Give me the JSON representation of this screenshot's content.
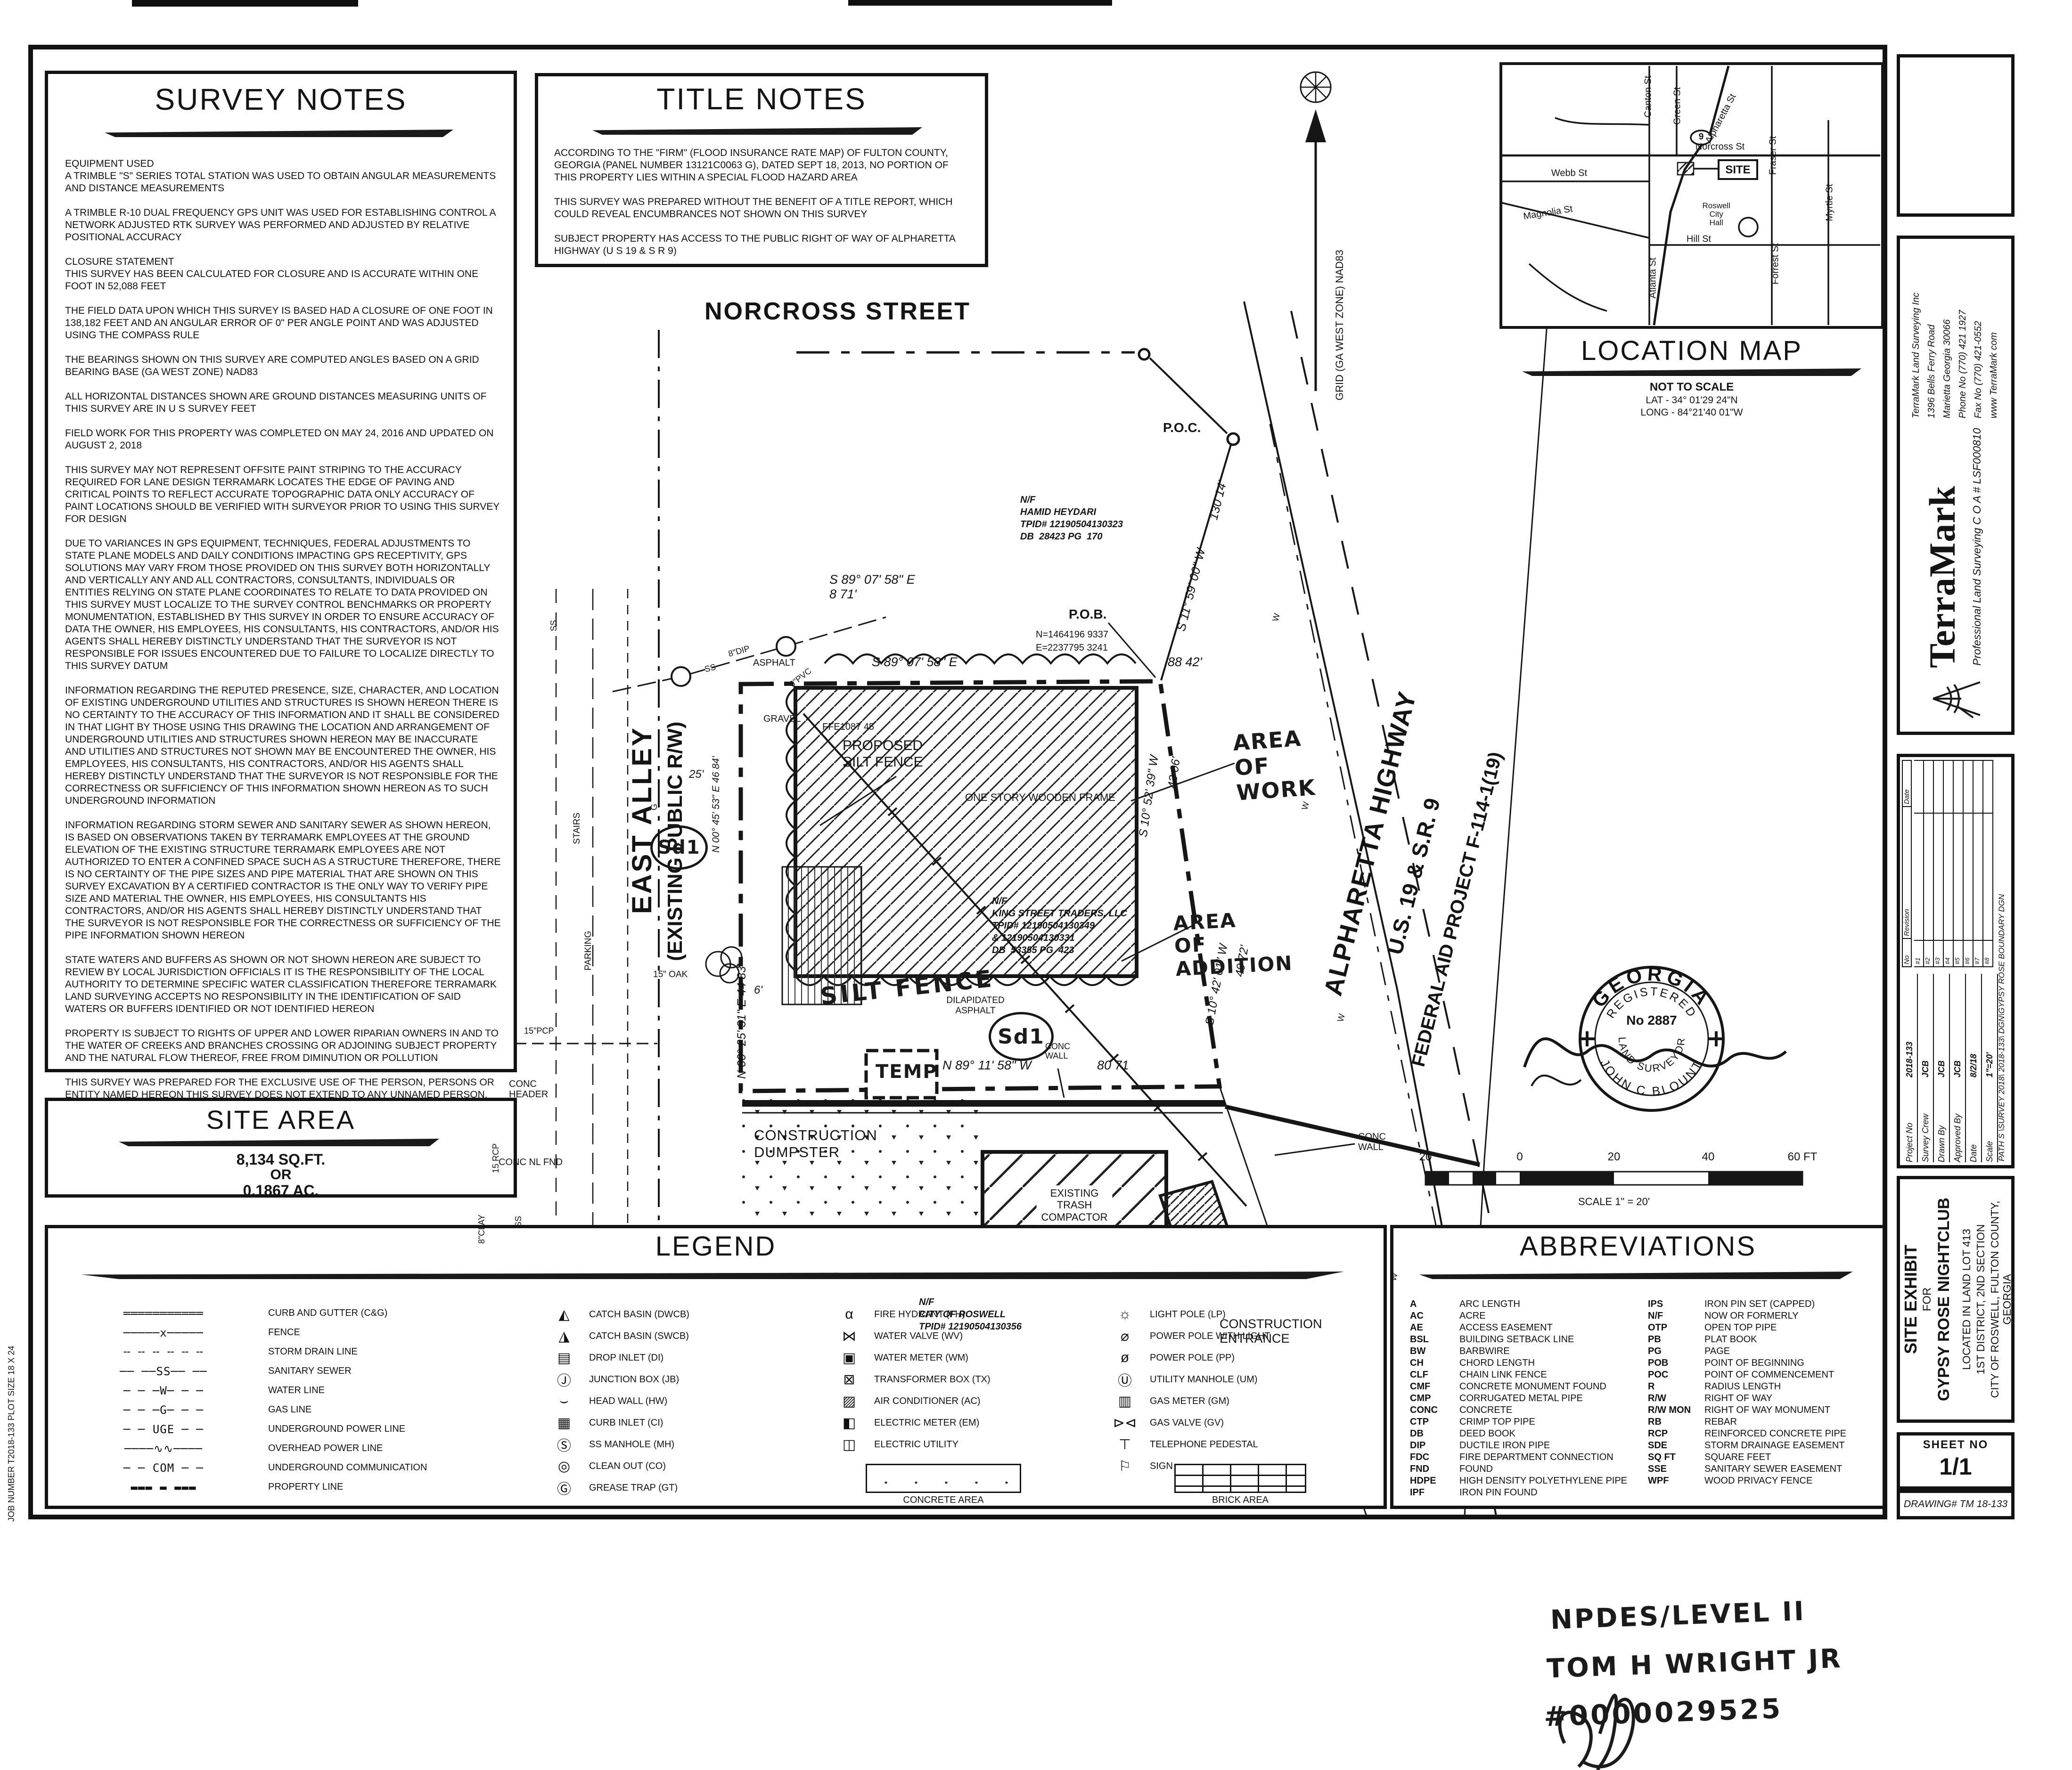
{
  "survey_notes": {
    "title": "SURVEY NOTES",
    "paragraphs": [
      "EQUIPMENT USED\nA TRIMBLE \"S\" SERIES TOTAL STATION WAS USED TO OBTAIN ANGULAR MEASUREMENTS AND DISTANCE MEASUREMENTS",
      "A TRIMBLE R-10 DUAL FREQUENCY GPS UNIT WAS USED FOR ESTABLISHING CONTROL  A NETWORK ADJUSTED RTK SURVEY WAS PERFORMED AND ADJUSTED BY RELATIVE POSITIONAL ACCURACY",
      "CLOSURE STATEMENT\nTHIS SURVEY HAS BEEN CALCULATED FOR CLOSURE AND IS ACCURATE WITHIN ONE FOOT IN 52,088 FEET",
      "THE FIELD DATA UPON WHICH THIS SURVEY IS BASED HAD A CLOSURE OF ONE FOOT IN 138,182 FEET AND AN ANGULAR ERROR OF 0\" PER ANGLE POINT AND WAS ADJUSTED USING THE COMPASS RULE",
      "THE BEARINGS SHOWN ON THIS SURVEY ARE COMPUTED ANGLES BASED ON A GRID BEARING BASE (GA WEST ZONE) NAD83",
      "ALL HORIZONTAL DISTANCES SHOWN ARE GROUND DISTANCES  MEASURING UNITS OF THIS SURVEY ARE IN U S  SURVEY FEET",
      "FIELD WORK FOR THIS PROPERTY WAS COMPLETED ON MAY 24, 2016 AND UPDATED ON AUGUST 2, 2018",
      "THIS SURVEY MAY NOT REPRESENT OFFSITE PAINT STRIPING TO THE ACCURACY REQUIRED FOR LANE DESIGN  TERRAMARK LOCATES THE EDGE OF PAVING AND CRITICAL POINTS TO REFLECT ACCURATE TOPOGRAPHIC DATA ONLY  ACCURACY OF PAINT LOCATIONS SHOULD BE VERIFIED WITH SURVEYOR PRIOR TO USING THIS SURVEY FOR DESIGN",
      "DUE TO VARIANCES IN GPS EQUIPMENT, TECHNIQUES, FEDERAL ADJUSTMENTS TO STATE PLANE MODELS AND DAILY CONDITIONS IMPACTING GPS RECEPTIVITY, GPS SOLUTIONS MAY VARY FROM THOSE PROVIDED ON THIS SURVEY BOTH HORIZONTALLY AND VERTICALLY   ANY AND ALL CONTRACTORS, CONSULTANTS, INDIVIDUALS OR ENTITIES RELYING ON STATE PLANE COORDINATES TO RELATE TO DATA PROVIDED ON THIS SURVEY MUST LOCALIZE TO THE SURVEY CONTROL  BENCHMARKS OR PROPERTY MONUMENTATION, ESTABLISHED BY THIS SURVEY IN ORDER TO ENSURE ACCURACY OF DATA   THE OWNER, HIS EMPLOYEES, HIS CONSULTANTS, HIS CONTRACTORS, AND/OR HIS AGENTS SHALL HEREBY DISTINCTLY UNDERSTAND THAT THE SURVEYOR IS NOT RESPONSIBLE FOR ISSUES ENCOUNTERED DUE TO FAILURE TO LOCALIZE DIRECTLY TO THIS SURVEY DATUM",
      "INFORMATION REGARDING THE REPUTED PRESENCE, SIZE, CHARACTER, AND LOCATION OF EXISTING UNDERGROUND UTILITIES AND STRUCTURES IS SHOWN HEREON  THERE IS NO CERTAINTY TO THE ACCURACY OF THIS INFORMATION AND IT SHALL BE CONSIDERED IN THAT LIGHT BY THOSE USING THIS DRAWING  THE LOCATION AND ARRANGEMENT OF UNDERGROUND UTILITIES AND STRUCTURES SHOWN HEREON MAY BE INACCURATE AND UTILITIES AND STRUCTURES NOT SHOWN MAY BE ENCOUNTERED  THE OWNER, HIS EMPLOYEES, HIS CONSULTANTS, HIS CONTRACTORS, AND/OR HIS AGENTS SHALL HEREBY DISTINCTLY UNDERSTAND THAT THE SURVEYOR IS NOT RESPONSIBLE FOR THE CORRECTNESS OR SUFFICIENCY OF THIS INFORMATION SHOWN HEREON AS TO SUCH UNDERGROUND INFORMATION",
      "INFORMATION REGARDING STORM SEWER AND SANITARY SEWER AS SHOWN HEREON, IS BASED ON OBSERVATIONS TAKEN BY TERRAMARK EMPLOYEES AT THE GROUND ELEVATION OF THE EXISTING STRUCTURE   TERRAMARK EMPLOYEES ARE NOT AUTHORIZED TO ENTER A CONFINED SPACE SUCH AS A STRUCTURE  THEREFORE, THERE IS NO CERTAINTY OF THE PIPE SIZES AND PIPE MATERIAL THAT ARE SHOWN ON THIS SURVEY   EXCAVATION BY A CERTIFIED CONTRACTOR IS THE ONLY WAY TO VERIFY PIPE SIZE AND MATERIAL   THE OWNER, HIS EMPLOYEES, HIS CONSULTANTS  HIS CONTRACTORS, AND/OR HIS AGENTS SHALL HEREBY DISTINCTLY UNDERSTAND THAT THE SURVEYOR IS NOT RESPONSIBLE FOR THE CORRECTNESS OR SUFFICIENCY OF THE PIPE INFORMATION SHOWN HEREON",
      "STATE WATERS AND BUFFERS AS SHOWN OR NOT SHOWN HEREON ARE SUBJECT TO REVIEW BY LOCAL JURISDICTION OFFICIALS   IT IS THE RESPONSIBILITY OF THE LOCAL AUTHORITY TO DETERMINE SPECIFIC WATER CLASSIFICATION   THEREFORE TERRAMARK LAND SURVEYING ACCEPTS NO RESPONSIBILITY IN THE IDENTIFICATION OF SAID WATERS OR BUFFERS IDENTIFIED OR NOT IDENTIFIED HEREON",
      "PROPERTY IS SUBJECT TO RIGHTS OF UPPER AND LOWER RIPARIAN OWNERS IN AND TO THE WATER OF CREEKS AND BRANCHES CROSSING OR ADJOINING SUBJECT PROPERTY AND THE NATURAL FLOW THEREOF, FREE FROM DIMINUTION OR POLLUTION",
      "THIS SURVEY WAS PREPARED FOR THE EXCLUSIVE USE OF THE PERSON, PERSONS OR ENTITY NAMED HEREON  THIS SURVEY DOES NOT EXTEND TO ANY UNNAMED PERSON, PERSONS OR ENTITY WITHOUT THE EXPRESS CERTIFICATION BY THE SURVEYOR NAMING SAID PERSON, PERSONS OR ENTITY",
      "TERRAMARK LAND SURVEYING, INC  DOES NOT WARRANT THE EXISTENCE OR NON -EXISTENCE OF ANY WETLANDS OR HAZARDOUS WASTE IN THE SURVEY AREA"
    ]
  },
  "title_notes": {
    "title": "TITLE NOTES",
    "paragraphs": [
      "ACCORDING TO THE \"FIRM\" (FLOOD INSURANCE RATE MAP) OF FULTON COUNTY, GEORGIA (PANEL NUMBER 13121C0063 G), DATED SEPT  18, 2013, NO PORTION OF THIS PROPERTY LIES WITHIN A SPECIAL FLOOD HAZARD AREA",
      "THIS SURVEY WAS PREPARED WITHOUT THE BENEFIT OF A TITLE REPORT, WHICH COULD REVEAL ENCUMBRANCES NOT SHOWN ON THIS SURVEY",
      "SUBJECT PROPERTY HAS ACCESS TO THE PUBLIC RIGHT OF WAY OF ALPHARETTA HIGHWAY (U S  19 & S R  9)"
    ]
  },
  "site_area": {
    "title": "SITE AREA",
    "sqft": "8,134 SQ.FT.",
    "or": "OR",
    "acres": "0.1867 AC."
  },
  "location_map": {
    "title": "LOCATION MAP",
    "not_to_scale": "NOT TO SCALE",
    "lat": "LAT -  34° 01'29 24\"N",
    "long": "LONG -  84°21'40 01\"W",
    "site": "SITE",
    "shield": "9",
    "city_hall": "Roswell\nCity\nHall",
    "streets": {
      "canton": "Canton St",
      "green": "Green St",
      "alpharetta": "Alpharetta St",
      "fraser": "Fraser St",
      "norcross": "Norcross St",
      "webb": "Webb St",
      "forrest": "Forrest St",
      "myrtle": "Myrtle St",
      "magnolia": "Magnolia St",
      "atlanta": "Atlanta St",
      "hill": "Hill St"
    }
  },
  "legend": {
    "title": "LEGEND",
    "lines": [
      {
        "glyph": "═══════════",
        "label": "CURB AND GUTTER (C&G)"
      },
      {
        "glyph": "─────x─────",
        "label": "FENCE"
      },
      {
        "glyph": "╌ ╌ ╌ ╌ ╌ ╌",
        "label": "STORM DRAIN LINE"
      },
      {
        "glyph": "── ──SS── ──",
        "label": "SANITARY SEWER"
      },
      {
        "glyph": "─ ─ ─W─ ─ ─",
        "label": "WATER LINE"
      },
      {
        "glyph": "─ ─ ─G─ ─ ─",
        "label": "GAS LINE"
      },
      {
        "glyph": "─ ─ UGE ─ ─",
        "label": "UNDERGROUND POWER LINE"
      },
      {
        "glyph": "────∿∿────",
        "label": "OVERHEAD POWER LINE"
      },
      {
        "glyph": "─ ─ COM ─ ─",
        "label": "UNDERGROUND COMMUNICATION"
      },
      {
        "glyph": "▬▬▬ ▬ ▬▬▬",
        "label": "PROPERTY LINE"
      }
    ],
    "col2": [
      {
        "glyph": "◭",
        "label": "CATCH BASIN (DWCB)"
      },
      {
        "glyph": "◮",
        "label": "CATCH BASIN (SWCB)"
      },
      {
        "glyph": "▤",
        "label": "DROP INLET (DI)"
      },
      {
        "glyph": "Ⓙ",
        "label": "JUNCTION BOX (JB)"
      },
      {
        "glyph": "⌣",
        "label": "HEAD WALL (HW)"
      },
      {
        "glyph": "▦",
        "label": "CURB INLET (CI)"
      },
      {
        "glyph": "Ⓢ",
        "label": "SS MANHOLE (MH)"
      },
      {
        "glyph": "◎",
        "label": "CLEAN OUT (CO)"
      },
      {
        "glyph": "Ⓖ",
        "label": "GREASE TRAP (GT)"
      }
    ],
    "col3": [
      {
        "glyph": "α",
        "label": "FIRE HYDRANT (FH)"
      },
      {
        "glyph": "⋈",
        "label": "WATER VALVE (WV)"
      },
      {
        "glyph": "▣",
        "label": "WATER METER (WM)"
      },
      {
        "glyph": "⊠",
        "label": "TRANSFORMER BOX (TX)"
      },
      {
        "glyph": "▨",
        "label": "AIR CONDITIONER (AC)"
      },
      {
        "glyph": "◧",
        "label": "ELECTRIC METER (EM)"
      },
      {
        "glyph": "◫",
        "label": "ELECTRIC UTILITY"
      }
    ],
    "col4": [
      {
        "glyph": "☼",
        "label": "LIGHT POLE (LP)"
      },
      {
        "glyph": "⌀",
        "label": "POWER POLE WITH LIGHT"
      },
      {
        "glyph": "ø",
        "label": "POWER POLE (PP)"
      },
      {
        "glyph": "Ⓤ",
        "label": "UTILITY MANHOLE (UM)"
      },
      {
        "glyph": "▥",
        "label": "GAS METER (GM)"
      },
      {
        "glyph": "⊳⊲",
        "label": "GAS VALVE (GV)"
      },
      {
        "glyph": "⊤",
        "label": "TELEPHONE PEDESTAL"
      },
      {
        "glyph": "⚐",
        "label": "SIGN"
      }
    ],
    "concrete_area": "CONCRETE AREA",
    "brick_area": "BRICK AREA"
  },
  "abbreviations": {
    "title": "ABBREVIATIONS",
    "col1": [
      {
        "a": "A",
        "t": "ARC LENGTH"
      },
      {
        "a": "AC",
        "t": "ACRE"
      },
      {
        "a": "AE",
        "t": "ACCESS EASEMENT"
      },
      {
        "a": "BSL",
        "t": "BUILDING SETBACK LINE"
      },
      {
        "a": "BW",
        "t": "BARBWIRE"
      },
      {
        "a": "CH",
        "t": "CHORD LENGTH"
      },
      {
        "a": "CLF",
        "t": "CHAIN LINK FENCE"
      },
      {
        "a": "CMF",
        "t": "CONCRETE MONUMENT FOUND"
      },
      {
        "a": "CMP",
        "t": "CORRUGATED METAL PIPE"
      },
      {
        "a": "CONC",
        "t": "CONCRETE"
      },
      {
        "a": "CTP",
        "t": "CRIMP TOP PIPE"
      },
      {
        "a": "DB",
        "t": "DEED BOOK"
      },
      {
        "a": "DIP",
        "t": "DUCTILE IRON PIPE"
      },
      {
        "a": "FDC",
        "t": "FIRE DEPARTMENT CONNECTION"
      },
      {
        "a": "FND",
        "t": "FOUND"
      },
      {
        "a": "HDPE",
        "t": "HIGH DENSITY POLYETHYLENE PIPE"
      },
      {
        "a": "IPF",
        "t": "IRON PIN FOUND"
      }
    ],
    "col2": [
      {
        "a": "IPS",
        "t": "IRON PIN SET (CAPPED)"
      },
      {
        "a": "N/F",
        "t": "NOW OR FORMERLY"
      },
      {
        "a": "OTP",
        "t": "OPEN TOP PIPE"
      },
      {
        "a": "PB",
        "t": "PLAT BOOK"
      },
      {
        "a": "PG",
        "t": "PAGE"
      },
      {
        "a": "POB",
        "t": "POINT OF BEGINNING"
      },
      {
        "a": "POC",
        "t": "POINT OF COMMENCEMENT"
      },
      {
        "a": "R",
        "t": "RADIUS LENGTH"
      },
      {
        "a": "R/W",
        "t": "RIGHT OF WAY"
      },
      {
        "a": "R/W MON",
        "t": "RIGHT OF WAY MONUMENT"
      },
      {
        "a": "RB",
        "t": "REBAR"
      },
      {
        "a": "RCP",
        "t": "REINFORCED CONCRETE PIPE"
      },
      {
        "a": "SDE",
        "t": "STORM DRAINAGE EASEMENT"
      },
      {
        "a": "SQ  FT",
        "t": "SQUARE FEET"
      },
      {
        "a": "SSE",
        "t": "SANITARY SEWER EASEMENT"
      },
      {
        "a": "WPF",
        "t": "WOOD PRIVACY FENCE"
      }
    ]
  },
  "plan": {
    "norcross_street": "NORCROSS STREET",
    "east_alley": "EAST ALLEY",
    "east_alley_rw": "(EXISTING PUBLIC R/W)",
    "grid_note": "GRID (GA WEST ZONE) NAD83",
    "poc": "P.O.C.",
    "poc_dist": "130 14'",
    "poc_brg": "S 11° 59' 00\" W",
    "nf_heydari": "N/F\nHAMID HEYDARI\nTPID# 12190504130323\nDB  28423 PG  170",
    "seg1": "S 89° 07' 58\" E\n8 71'",
    "pob": "P.O.B.",
    "pob_n": "N=1464196 9337",
    "pob_e": "E=2237795 3241",
    "top_brg": "S 89° 07' 58\" E",
    "top_dist": "88 42'",
    "gravel": "GRAVEL",
    "ffe": "FFE1087 45",
    "proposed_sf": "PROPOSED\nSILT FENCE",
    "building": "ONE STORY WOODEN FRAME",
    "right_brg1": "S 10° 52' 39\" W",
    "right_dist1": "43 06'",
    "right_brg2": "S 10° 42' 01\" W",
    "right_dist2": "49 72'",
    "area_work": "AREA\nOF\nWORK",
    "area_addition": "AREA\nOF\nADDITION",
    "nf_king": "N/F\nKING STREET TRADERS, LLC\nTPID# 12190504130349\n& 12190504130331\nDB  53355 PG  423",
    "dilapidated": "DILAPIDATED\nASPHALT",
    "silt_fence_hw": "SILT FENCE",
    "sd1": "Sd1",
    "dim25": "25'",
    "dim6": "6'",
    "west_brg1": "N 00° 45' 53\" E  46 84'",
    "west_brg2": "N 00° 25' 31\" E  44 83'",
    "oak15": "15\" OAK",
    "temp": "TEMP",
    "bottom_brg": "N 89° 11' 58\" W",
    "bottom_dist": "80 71",
    "conc_wall": "CONC\nWALL",
    "conc_header": "CONC\nHEADER",
    "conc_nl": "CONC NL FND",
    "rcp15": "15 RCP",
    "pcp15": "15\"PCP",
    "clay8": "8\"CLAY",
    "dip8": "8\"DIP",
    "pvc6": "6\"PVC",
    "ss": "SS",
    "g": "G",
    "w": "W",
    "asphalt": "ASPHALT",
    "parking": "PARKING",
    "stairs": "STAIRS",
    "dumpster": "CONSTRUCTION\nDUMPSTER",
    "compactor": "EXISTING\nTRASH\nCOMPACTOR",
    "nf_roswell": "N/F\nCITY OF ROSWELL\nTPID# 12190504130356",
    "entrance": "CONSTRUCTION\nENTRANCE",
    "hwy1": "ALPHARETTA HIGHWAY",
    "hwy2": "U.S. 19 & S.R. 9",
    "hwy3": "FEDERAL AID PROJECT F-114-1(19)"
  },
  "scale_bar": {
    "t1": "20",
    "t2": "0",
    "t3": "20",
    "t4": "40",
    "t5": "60 FT",
    "label": "SCALE   1\" = 20'"
  },
  "seal": {
    "state": "GEORGIA",
    "registered": "REGISTERED",
    "number": "No  2887",
    "surveyor": "LAND SURVEYOR",
    "name": "JOHN C BLOUNT"
  },
  "titleblock": {
    "terramark": {
      "logo": "TerraMark",
      "tagline": "Professional Land Surveying  C O A # LSF000810",
      "address": "TerraMark Land Surveying  Inc\n1396 Bells Ferry Road\nMarietta  Georgia 30066\nPhone No (770) 421 1927\nFax  No (770) 421-0552\nwww TerraMark com"
    },
    "revision": {
      "no_h": "No",
      "rev_h": "Revision",
      "date_h": "Date",
      "rows": [
        "#1",
        "#2",
        "#3",
        "#4",
        "#5",
        "#6",
        "#7",
        "#8"
      ],
      "fields": [
        {
          "k": "Project No",
          "v": "2018-133"
        },
        {
          "k": "Survey Crew",
          "v": "JCB"
        },
        {
          "k": "Drawn By",
          "v": "JCB"
        },
        {
          "k": "Approved By",
          "v": "JCB"
        },
        {
          "k": "Date",
          "v": "8/2/18"
        },
        {
          "k": "Scale",
          "v": "1\"=20'"
        }
      ],
      "path": "PATH  S \\SURVEY 2018\\ 2018-133\\ DGN\\GYPSY ROSE BOUNDARY DGN"
    },
    "exhibit": {
      "l1": "SITE EXHIBIT",
      "l2": "FOR",
      "l3": "GYPSY ROSE NIGHTCLUB",
      "l4": "LOCATED IN LAND LOT 413",
      "l5": "1ST DISTRICT, 2ND SECTION",
      "l6": "CITY OF ROSWELL, FULTON COUNTY, GEORGIA"
    },
    "sheet": {
      "label": "SHEET NO",
      "value": "1/1",
      "drawing": "DRAWING# TM 18-133"
    }
  },
  "margin": {
    "job": "JOB NUMBER T2018-133     PLOT SIZE 18 X 24"
  },
  "handwritten": {
    "l1": "NPDES/LEVEL II",
    "l2": "TOM H WRIGHT JR",
    "l3": "#0000029525"
  }
}
